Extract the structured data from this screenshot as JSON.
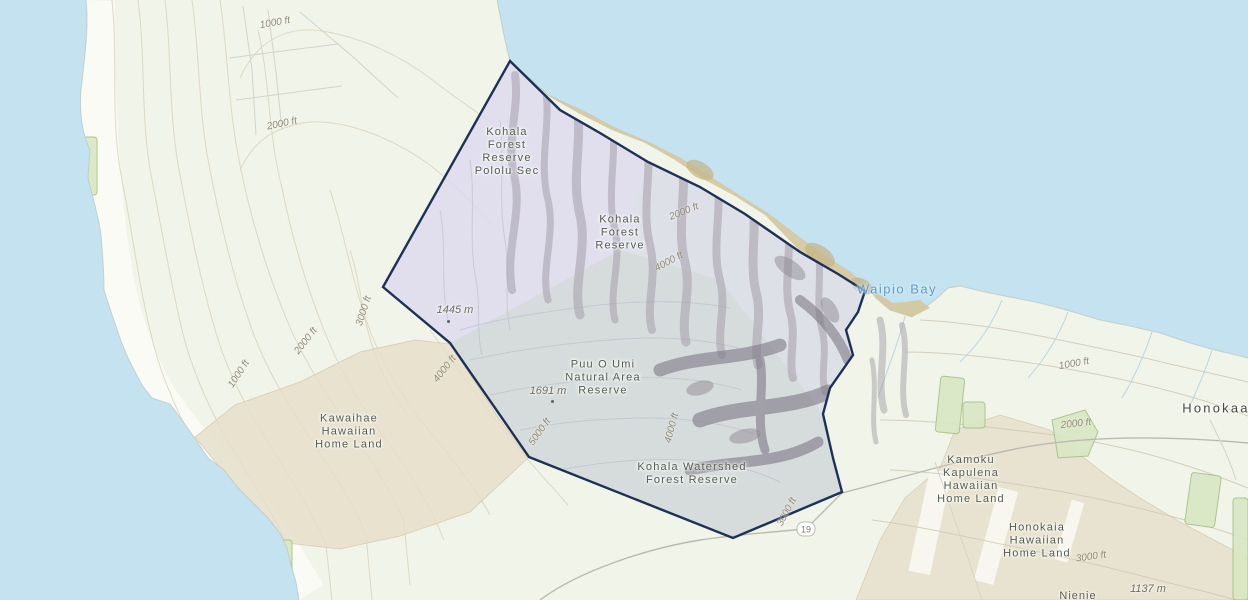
{
  "map": {
    "description": "Topographic map of the Kohala region, island of Hawaii, with a highlighted reserve boundary polygon",
    "highlight": {
      "name": "highlighted reserve boundary",
      "border_color": "#1d3157",
      "fill_color": "#d7d7ec"
    },
    "area_labels": [
      {
        "id": "kohala-forest-reserve-pololu-sec",
        "lines": [
          "Kohala",
          "Forest",
          "Reserve",
          "Pololu Sec"
        ]
      },
      {
        "id": "kohala-forest-reserve",
        "lines": [
          "Kohala",
          "Forest",
          "Reserve"
        ]
      },
      {
        "id": "puu-o-umi-natural-area-reserve",
        "lines": [
          "Puu O Umi",
          "Natural Area",
          "Reserve"
        ]
      },
      {
        "id": "kohala-watershed-forest-reserve",
        "lines": [
          "Kohala Watershed",
          "Forest Reserve"
        ]
      },
      {
        "id": "kawaihae-hawaiian-home-land",
        "lines": [
          "Kawaihae",
          "Hawaiian",
          "Home Land"
        ]
      },
      {
        "id": "kamoku-kapulena-hawaiian-home-land",
        "lines": [
          "Kamoku",
          "Kapulena",
          "Hawaiian",
          "Home Land"
        ]
      },
      {
        "id": "honokaia-hawaiian-home-land",
        "lines": [
          "Honokaia",
          "Hawaiian",
          "Home Land"
        ]
      }
    ],
    "place_labels": [
      {
        "id": "honokaa",
        "text": "Honokaa"
      },
      {
        "id": "waipio-bay",
        "text": "Waipio Bay"
      },
      {
        "id": "nienie",
        "text": "Nienie"
      }
    ],
    "elevation_markers": [
      {
        "text": "1445 m"
      },
      {
        "text": "1691 m"
      },
      {
        "text": "1137 m"
      }
    ],
    "contour_labels": [
      {
        "text": "1000 ft"
      },
      {
        "text": "2000 ft"
      },
      {
        "text": "1000 ft"
      },
      {
        "text": "2000 ft"
      },
      {
        "text": "3000 ft"
      },
      {
        "text": "4000 ft"
      },
      {
        "text": "5000 ft"
      },
      {
        "text": "2000 ft"
      },
      {
        "text": "4000 ft"
      },
      {
        "text": "4000 ft"
      },
      {
        "text": "3000 ft"
      },
      {
        "text": "1000 ft"
      },
      {
        "text": "2000 ft"
      },
      {
        "text": "3000 ft"
      }
    ],
    "route_shield": {
      "number": "19"
    },
    "colors": {
      "ocean": "#c5e2f1",
      "land": "#f1f4e9",
      "homeland_tan": "#e7dfcb",
      "reserve_green": "#d8e7c3",
      "reserve_green_border": "#a3c183",
      "coastal_cliff_tan": "#d5c79c",
      "road": "#bcbab0",
      "contour_west": "#d9d2b8",
      "contour_east": "#cfc9b4",
      "hillshade": "#8e8994"
    }
  }
}
